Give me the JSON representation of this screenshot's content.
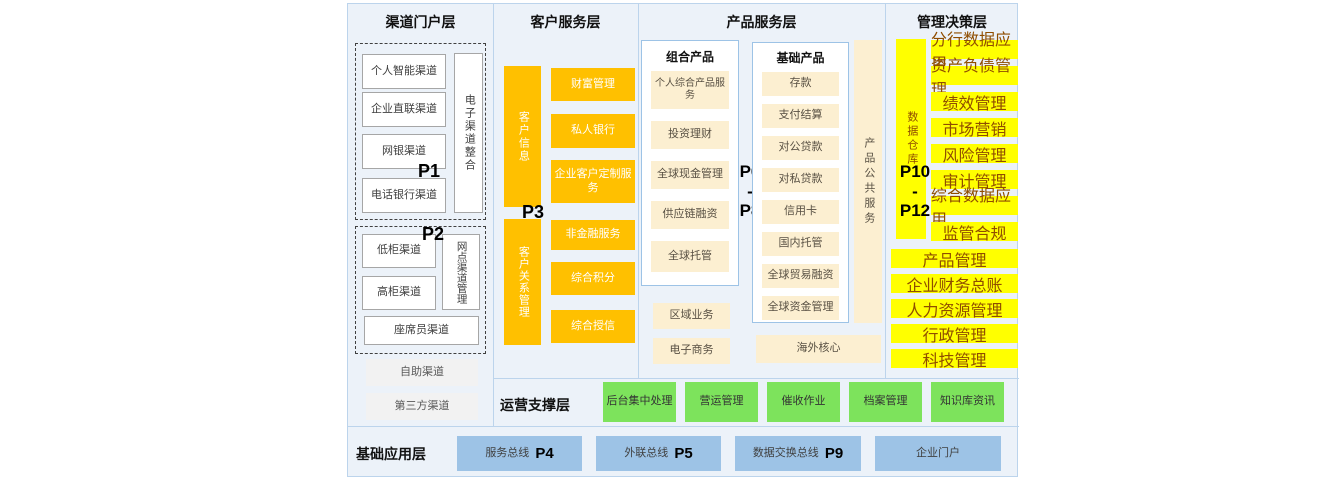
{
  "colors": {
    "background": "#ECF2F9",
    "line": "#BCD4EC",
    "orange": "#FFC000",
    "cream": "#FCEFD1",
    "yellow": "#FFFF00",
    "green": "#7DE35C",
    "blue": "#9DC3E6",
    "gray_box": "#F2F2F2"
  },
  "channel": {
    "title": "渠道门户层",
    "p1": {
      "label": "P1",
      "boxes": [
        "个人智能渠道",
        "企业直联渠道",
        "网银渠道",
        "电话银行渠道"
      ],
      "vertical": "电子渠道整合"
    },
    "p2": {
      "label": "P2",
      "boxes": [
        "低柜渠道",
        "高柜渠道"
      ],
      "vertical": "网点渠道管理",
      "wide": "座席员渠道"
    },
    "extra": [
      "自助渠道",
      "第三方渠道"
    ]
  },
  "customer": {
    "title": "客户服务层",
    "p3_label": "P3",
    "vertical_top": "客户信息",
    "top_boxes": [
      "财富管理",
      "私人银行",
      "企业客户定制服务"
    ],
    "vertical_bottom": "客户关系管理",
    "bottom_boxes": [
      "非金融服务",
      "综合积分",
      "综合授信"
    ]
  },
  "product": {
    "title": "产品服务层",
    "p_range": {
      "top": "P6",
      "sep": "-",
      "bottom": "P8"
    },
    "combo": {
      "title": "组合产品",
      "items": [
        "个人综合产品服务",
        "投资理财",
        "全球现金管理",
        "供应链融资",
        "全球托管"
      ]
    },
    "combo_extra": [
      "区域业务",
      "电子商务"
    ],
    "basic": {
      "title": "基础产品",
      "items": [
        "存款",
        "支付结算",
        "对公贷款",
        "对私贷款",
        "信用卡",
        "国内托管",
        "全球贸易融资",
        "全球资金管理"
      ]
    },
    "vertical": "产品公共服务",
    "overseas": "海外核心"
  },
  "management": {
    "title": "管理决策层",
    "p_range": {
      "top": "P10",
      "sep": "-",
      "bottom": "P12"
    },
    "vertical": "数据仓库",
    "narrow_boxes": [
      "分行数据应用",
      "资产负债管理",
      "绩效管理",
      "市场营销",
      "风险管理",
      "审计管理",
      "综合数据应用",
      "监管合规"
    ],
    "wide_boxes": [
      "产品管理",
      "企业财务总账",
      "人力资源管理",
      "行政管理",
      "科技管理"
    ]
  },
  "operation": {
    "title": "运营支撑层",
    "boxes": [
      "后台集中处理",
      "营运管理",
      "催收作业",
      "档案管理",
      "知识库资讯"
    ]
  },
  "foundation": {
    "title": "基础应用层",
    "boxes": [
      {
        "label": "服务总线",
        "p": "P4"
      },
      {
        "label": "外联总线",
        "p": "P5"
      },
      {
        "label": "数据交换总线",
        "p": "P9"
      },
      {
        "label": "企业门户",
        "p": ""
      }
    ]
  }
}
